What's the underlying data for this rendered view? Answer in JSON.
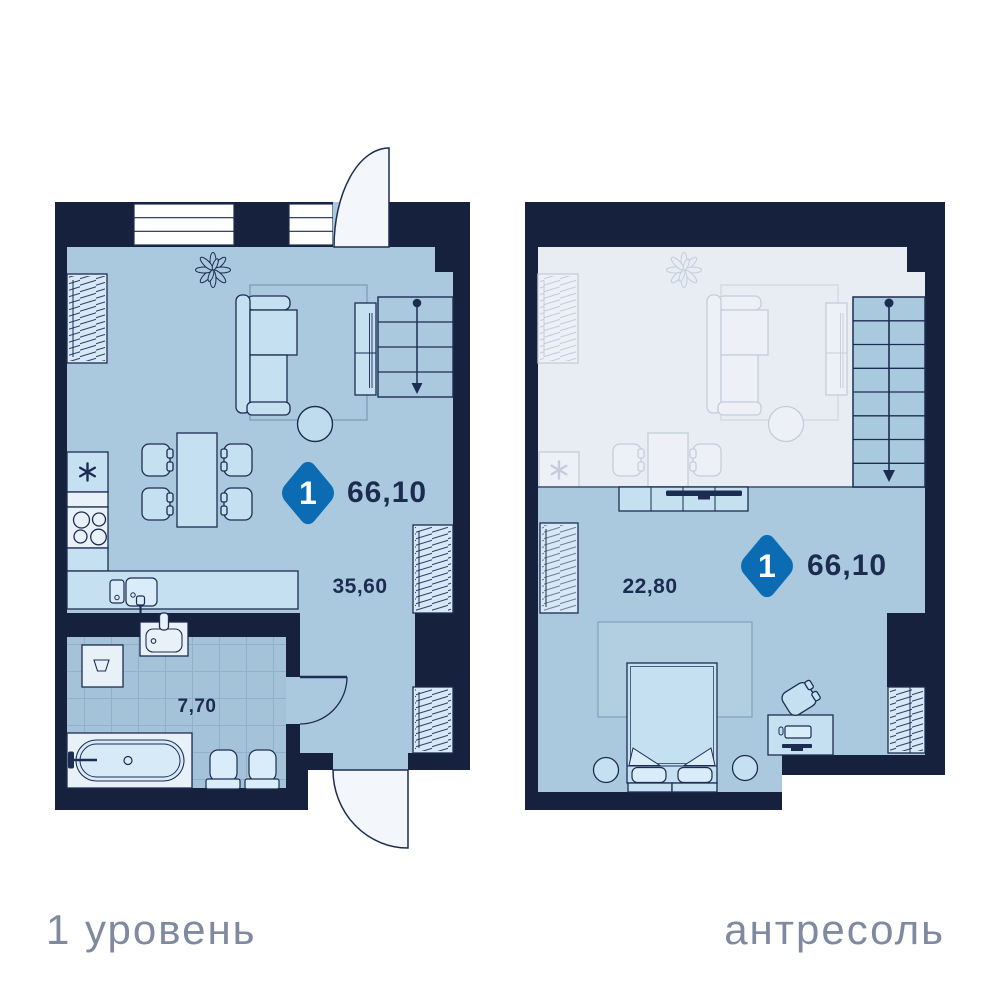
{
  "plans": {
    "level1": {
      "label": "1 уровень",
      "badge_number": "1",
      "total_area": "66,10",
      "rooms": {
        "living_kitchen": "35,60",
        "bathroom": "7,70"
      }
    },
    "mezzanine": {
      "label": "антресоль",
      "badge_number": "1",
      "total_area": "66,10",
      "rooms": {
        "bedroom": "22,80"
      }
    }
  },
  "colors": {
    "wall": "#16213E",
    "floor": "#ABC9DE",
    "furniture": "#C5E0F1",
    "ghost_floor": "#E8EDF4",
    "badge_blue": "#0B6CB4",
    "dimension_text": "#1C2C50",
    "label_text": "#7F8AA0",
    "background": "#FFFFFF"
  }
}
